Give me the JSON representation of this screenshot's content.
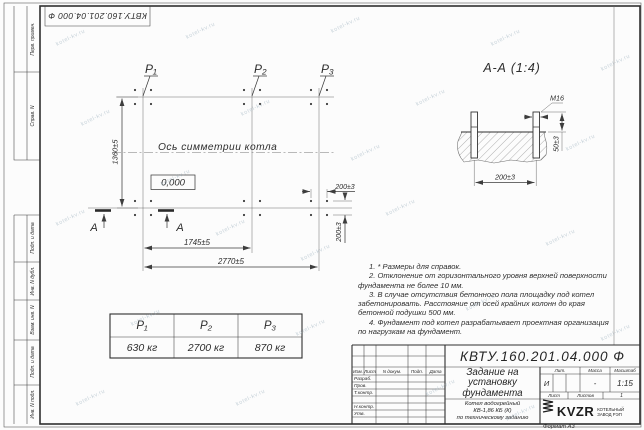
{
  "watermark": "kotel-kv.ru",
  "frame": {
    "corner_designation": "КВТУ.160.201.04.000 Ф",
    "side_stamps_top": [
      "Перв. примен.",
      "Справ. N"
    ],
    "side_stamps_bottom": [
      "Подп. и дата",
      "Инв. N дубл.",
      "Взам. инв. N",
      "Подп. и дата",
      "Инв. N подл."
    ],
    "format_note": "Формат А3"
  },
  "plan": {
    "point_labels": [
      "P₁",
      "P₂",
      "P₃"
    ],
    "symmetry_axis_label": "Ось симметрии котла",
    "elevation_mark": "0,000",
    "section_letter": "А",
    "dim_height": "1360±5",
    "dim_span_p1_p2": "1745±5",
    "dim_span_total": "2770±5",
    "dim_bolt_spacing_x": "200±3",
    "dim_bolt_spacing_y": "200±3"
  },
  "section_view": {
    "title": "А-А (1:4)",
    "thread_label": "М16",
    "dim_bolt_spacing": "200±3",
    "dim_protrusion": "50±3"
  },
  "notes": [
    "1. * Размеры для справок.",
    "2. Отклонение от горизонтального уровня верхней поверхности фундамента не более 10 мм.",
    "3. В случае отсутствия бетонного пола площадку под котел забетонировать. Расстояние от осей крайних колонн до края бетонной подушки 500 мм.",
    "4. Фундамент под котел разрабатывает проектная организация по нагрузкам на фундамент."
  ],
  "load_table": {
    "headers": [
      "P₁",
      "P₂",
      "P₃"
    ],
    "values": [
      "630 кг",
      "2700 кг",
      "870 кг"
    ]
  },
  "title_block": {
    "designation": "КВТУ.160.201.04.000 Ф",
    "doc_title_lines": [
      "Задание на",
      "установку",
      "фундамента"
    ],
    "product_lines": [
      "Котел водогрейный",
      "КВ-1,86 КБ (К)",
      "по техническому заданию"
    ],
    "header_cols": [
      "Изм.",
      "Лист",
      "N докум.",
      "Подп.",
      "Дата"
    ],
    "signature_rows": [
      "Разраб.",
      "Пров.",
      "Т.контр.",
      "Н.контр.",
      "Утв."
    ],
    "lit_label": "Лит.",
    "lit_value": "И",
    "mass_label": "Масса",
    "mass_value": "-",
    "scale_label": "Масштаб",
    "scale_value": "1:15",
    "sheet_label": "Лист",
    "sheets_label": "Листов",
    "sheets_value": "1",
    "company_logo": "KVZR",
    "company_lines": [
      "КОТЕЛЬНЫЙ",
      "ЗАВОД РЭП"
    ]
  }
}
